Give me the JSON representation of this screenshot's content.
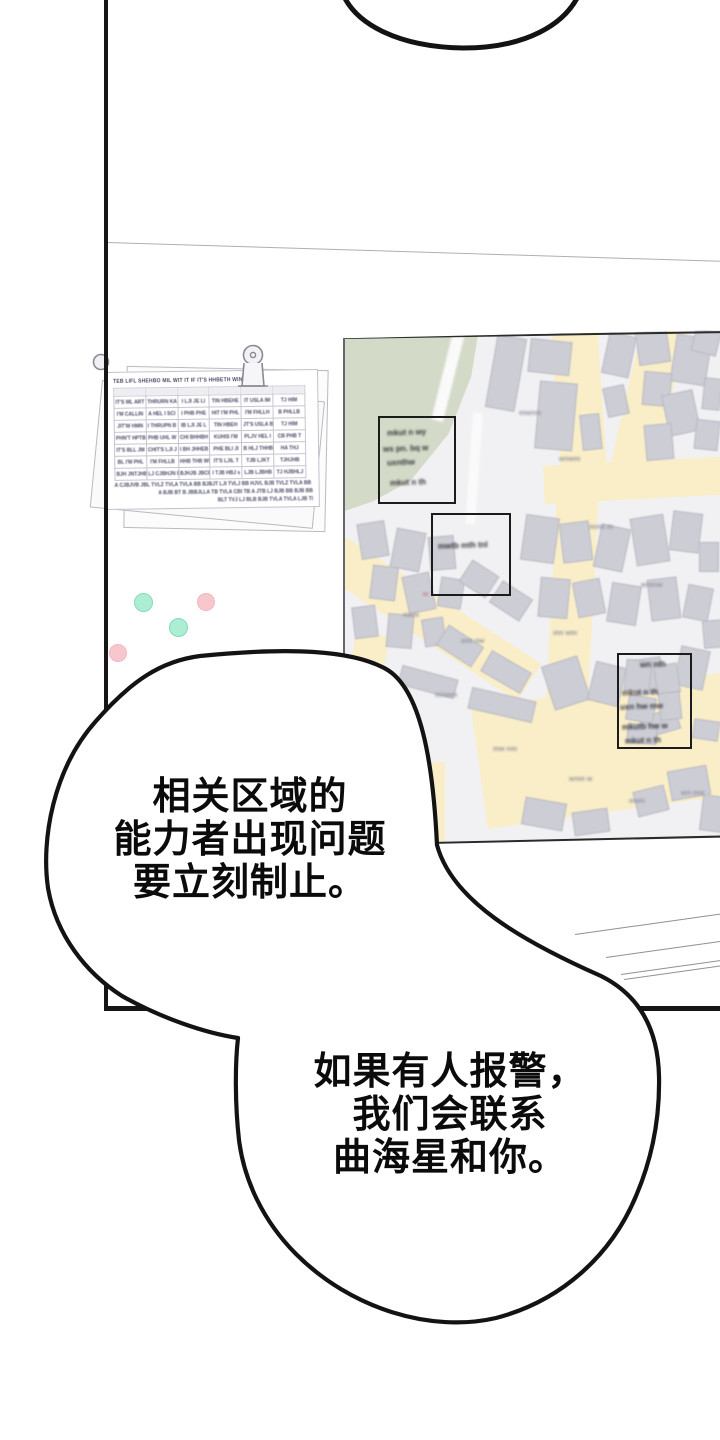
{
  "panel": {
    "type": "webtoon-comic-panel",
    "background": "#ffffff",
    "border_color": "#161616"
  },
  "speech_bubbles": [
    {
      "id": "bubble-top",
      "note": "partial bubble cut off at top of image",
      "lines": []
    },
    {
      "id": "bubble-1",
      "lines": [
        "相关区域的",
        "能力者出现问题",
        "要立刻制止。"
      ]
    },
    {
      "id": "bubble-2",
      "lines": [
        "如果有人报警，",
        "我们会联系",
        "曲海星和你。"
      ]
    }
  ],
  "wall": {
    "seam_line_color": "#aeaeb4",
    "pins": [
      {
        "color_name": "mint",
        "hex": "#abeed3"
      },
      {
        "color_name": "pink",
        "hex": "#f7c7cd"
      },
      {
        "color_name": "mint",
        "hex": "#abeed3"
      },
      {
        "color_name": "pink",
        "hex": "#f7c7cd"
      }
    ],
    "document": {
      "clip_icon": "binder-clip-icon",
      "illegible_header": "TEB LIFL SHEHBO MIL WIT IT IF IT'S HHBETH WIN",
      "table": {
        "columns": 6,
        "rows": [
          [
            "IT'S ML ART",
            "THRURN KA",
            "I LJI JE LI",
            "TIN HBEHE",
            "IT USLA IM",
            "TJ HIM"
          ],
          [
            "I'M CALLIN",
            "A HEL I SCI",
            "I PHB PHE",
            "HIT I'M PHL",
            "I'M FHLLH",
            "B PHLLB"
          ],
          [
            "JIT'W HMN",
            "I THRUPN B",
            "IB LJI JE L",
            "TIN HBEH",
            "JT'S USLA B",
            "TJ HIM"
          ],
          [
            "PHN'T HPTB",
            "PHB UHL W",
            "CHI BHHBH",
            "KUHIS I'M",
            "PLJV HEL I",
            "CB PHB T"
          ],
          [
            "IT'S BLL JM",
            "CHIT'S LJI J",
            "I BH JHHEB",
            "PHE BLI JI",
            "B HLJ THHB",
            "HA THJ"
          ],
          [
            "BL I'M PHL",
            "I'M FHLLB",
            "HHB THB WI",
            "IT'S LJIL T",
            "TJB LJKT",
            "TJHJHB"
          ],
          [
            "BJH JNTJHB",
            "LJ CJBHJN B",
            "BJHJB JBCB",
            "I TJB HBJ s",
            "LJB LJBHB",
            "TJ HJBHLJ"
          ]
        ]
      },
      "illegible_footer_lines": [
        "A CJBJVB JBL TVLZ TVLA TVLA BB BJBJT LJI TVLJ BB HJVL BJB TVLZ TVLA BB BJBJT LJI TVTL JIB CJHL",
        "A BJB BT B JBBJLLA TB TVLA CBI TB A JTB LJ BJB BB BJB BB CBLA TVB BLA LJB A JBT BT BBL",
        "BLT TVJ LJ BLB BJB TVLA TVLA LJB TB BA BBL TB"
      ]
    },
    "map": {
      "colors": {
        "background": "#f1f1f3",
        "park_green": "#d4dac8",
        "road_yellow": "#f9eec7",
        "building_gray": "#cdcdd5",
        "annotation_box_border": "#1c1c1c",
        "edge_line": "#2b2b2b"
      },
      "annotation_boxes": [
        {
          "illegible_handwriting": [
            "mkut n wy",
            "ws pn. bq w",
            "uxnthw",
            "mkut n th"
          ]
        },
        {
          "illegible_handwriting": [
            "mwtb mth tnl"
          ]
        },
        {
          "illegible_handwriting": [
            "wn nth",
            "mkut n th",
            "uxn hw mw",
            "mkutb hw w",
            "mkut n th"
          ]
        }
      ],
      "illegible_labels": [
        "mwnm",
        "wnwm",
        "mnw m",
        "wmnw",
        "mw nm",
        "wnm w",
        "mwn",
        "wn mw",
        "mnwm",
        "wm nw",
        "nwm",
        "mn wm"
      ],
      "red_mark": "rv"
    }
  }
}
